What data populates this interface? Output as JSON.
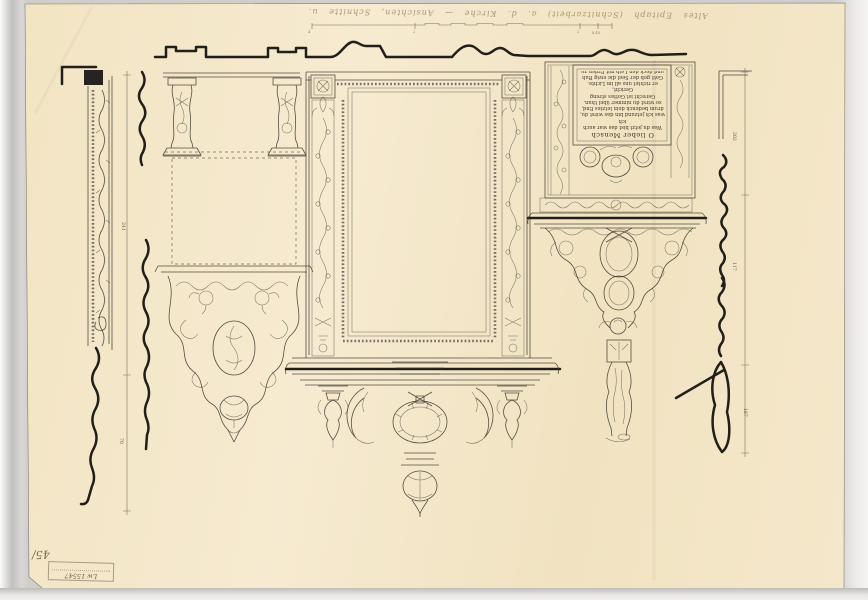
{
  "colors": {
    "paper": "#f4e7c7",
    "ink": "#36322b",
    "ink_bold": "#221f1a",
    "scanner_background": "#cfcecb",
    "stamp_ink": "#5a4f3e"
  },
  "handwriting": {
    "top_note": "Altes Epitaph (Schnitzarbeit) a. d. Kirche — Ansichten, Schnitte u. Profile — aufgen. 1913 nachmessen",
    "corner_mark": "45/"
  },
  "stamp": {
    "number": "Lw 15547"
  },
  "epitaph": {
    "header": "O lieber Mensch",
    "lines": [
      "Was du jetzt bist das war auch ich",
      "was ich jetzund bin das wirst du,",
      "drum bedenck dein letztes End,",
      "so wirst du nimmer übel thun.",
      "Gerecht ist Gottes streng Gericht,",
      "er richtet uns all im Lichte.",
      "Gott geb der Seel die ewig Ruh",
      "und deck den Leib mit Erden zu",
      "seine Ruh."
    ]
  },
  "dimensions": {
    "left": [
      "241",
      "70"
    ],
    "right": [
      "202",
      "117",
      "187"
    ],
    "top_labels": [
      "4",
      "2",
      "2",
      "8.40"
    ]
  }
}
